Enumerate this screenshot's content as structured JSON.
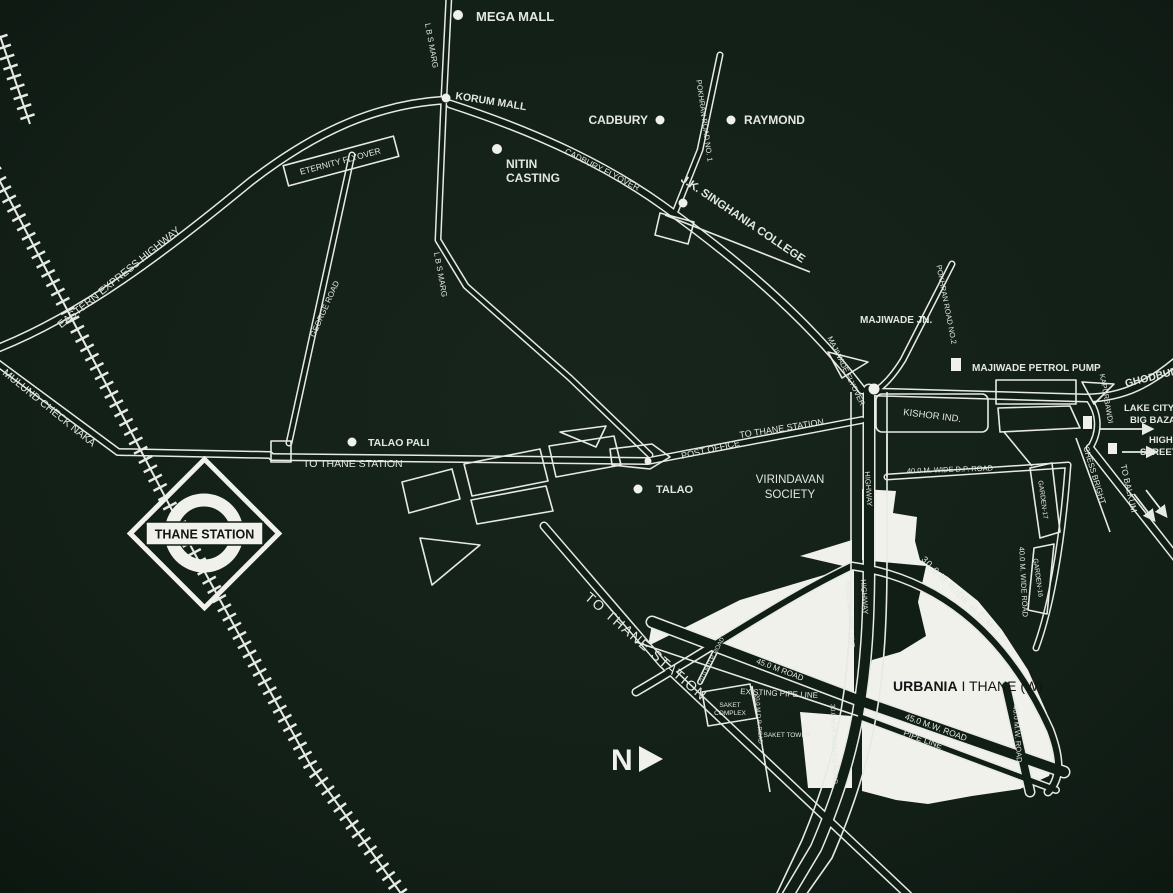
{
  "map": {
    "colors": {
      "background": "#121f17",
      "background_edge": "#0c1710",
      "road": "#e7eae4",
      "label": "#e3e7e1",
      "site": "#eff1ea",
      "dark": "#111e16",
      "text_dark": "#141414"
    },
    "station": {
      "name": "THANE STATION"
    },
    "north": {
      "label": "N"
    },
    "labels": [
      {
        "name": "label-mega-mall",
        "text": "MEGA MALL",
        "x": 476,
        "y": 21,
        "size": 13,
        "weight": 700,
        "anchor": "start"
      },
      {
        "name": "label-korum-mall",
        "text": "KORUM MALL",
        "x": 455,
        "y": 99,
        "rot": 9,
        "size": 10.5,
        "weight": 700,
        "anchor": "start"
      },
      {
        "name": "label-cadbury",
        "text": "CADBURY",
        "x": 648,
        "y": 124,
        "size": 12,
        "weight": 700,
        "anchor": "end"
      },
      {
        "name": "label-raymond",
        "text": "RAYMOND",
        "x": 744,
        "y": 124,
        "size": 12,
        "weight": 700,
        "anchor": "start"
      },
      {
        "name": "label-nitin-casting-1",
        "text": "NITIN",
        "x": 506,
        "y": 168,
        "size": 12,
        "weight": 700,
        "anchor": "start"
      },
      {
        "name": "label-nitin-casting-2",
        "text": "CASTING",
        "x": 506,
        "y": 182,
        "size": 12,
        "weight": 700,
        "anchor": "start"
      },
      {
        "name": "label-eternity-flyover",
        "text": "ETERNITY FLYOVER",
        "x": 341,
        "y": 164,
        "rot": -15,
        "size": 8.5
      },
      {
        "name": "label-eastern-express-highway",
        "text": "EASTERN EXPRESS HIGHWAY",
        "x": 121,
        "y": 280,
        "rot": -39,
        "size": 10.5
      },
      {
        "name": "label-mulund-check-naka",
        "text": "MULUND CHECK NAKA",
        "x": 2,
        "y": 374,
        "rot": 39,
        "size": 10.5,
        "anchor": "start"
      },
      {
        "name": "label-cadbury-flyover",
        "text": "CADBURY FLYOVER",
        "x": 601,
        "y": 172,
        "rot": 27,
        "size": 8.5
      },
      {
        "name": "label-lbs-marg-north",
        "text": "L B S MARG",
        "x": 429,
        "y": 46,
        "rot": 80,
        "size": 8
      },
      {
        "name": "label-lbs-marg-mid",
        "text": "L B S MARG",
        "x": 438,
        "y": 275,
        "rot": 80,
        "size": 8
      },
      {
        "name": "label-george-road",
        "text": "GEORGE ROAD",
        "x": 327,
        "y": 310,
        "rot": -66,
        "size": 8
      },
      {
        "name": "label-pokhran-road-1",
        "text": "POKHRAN ROAD NO. 1",
        "x": 702,
        "y": 121,
        "rot": 82,
        "size": 7.5
      },
      {
        "name": "label-jk-singhania-college",
        "text": "J.K. SINGHANIA COLLEGE",
        "x": 741,
        "y": 222,
        "rot": 34,
        "size": 11.5,
        "weight": 700
      },
      {
        "name": "label-pokhran-road-2",
        "text": "POKHRAN ROAD NO.2",
        "x": 944,
        "y": 305,
        "rot": 79,
        "size": 7.5
      },
      {
        "name": "label-majiwade-jn",
        "text": "MAJIWADE JN.",
        "x": 860,
        "y": 323,
        "size": 10,
        "weight": 700,
        "anchor": "start"
      },
      {
        "name": "label-majiwade-flyover",
        "text": "MAJIWADE FLYOVER",
        "x": 844,
        "y": 372,
        "rot": 64,
        "size": 7.5
      },
      {
        "name": "label-majiwade-petrol-pump",
        "text": "MAJIWADE PETROL PUMP",
        "x": 972,
        "y": 371,
        "size": 10,
        "weight": 700,
        "anchor": "start"
      },
      {
        "name": "label-ghodbunder-road",
        "text": "GHODBUNDER ROAD",
        "x": 1126,
        "y": 387,
        "rot": -14,
        "size": 10.5,
        "weight": 700,
        "anchor": "start"
      },
      {
        "name": "label-kapurbawdi",
        "text": "KAPURBAWDI",
        "x": 1104,
        "y": 399,
        "rot": 80,
        "size": 7.5
      },
      {
        "name": "label-lake-city-mall",
        "text": "LAKE CITY MALL",
        "x": 1124,
        "y": 411,
        "size": 9.5,
        "weight": 700,
        "anchor": "start"
      },
      {
        "name": "label-big-bazaar",
        "text": "BIG BAZAAR",
        "x": 1130,
        "y": 423,
        "size": 9.5,
        "weight": 700,
        "anchor": "start"
      },
      {
        "name": "label-high",
        "text": "HIGH",
        "x": 1149,
        "y": 443,
        "size": 9.5,
        "weight": 700,
        "anchor": "start"
      },
      {
        "name": "label-street-mall",
        "text": "STREET MALL",
        "x": 1140,
        "y": 455,
        "size": 9.5,
        "weight": 700,
        "anchor": "start"
      },
      {
        "name": "label-chess-bright",
        "text": "CHESS BRIGHT",
        "x": 1092,
        "y": 476,
        "rot": 73,
        "size": 8
      },
      {
        "name": "label-to-balkum",
        "text": "TO BALKUM",
        "x": 1126,
        "y": 489,
        "rot": 77,
        "size": 8.5
      },
      {
        "name": "label-kishor-ind",
        "text": "KISHOR IND.",
        "x": 903,
        "y": 415,
        "rot": 7,
        "size": 9.5,
        "anchor": "start"
      },
      {
        "name": "label-to-thane-station-west",
        "text": "TO THANE STATION",
        "x": 303,
        "y": 467,
        "size": 10.5,
        "anchor": "start"
      },
      {
        "name": "label-talao-pali",
        "text": "TALAO PALI",
        "x": 368,
        "y": 446,
        "size": 10.5,
        "weight": 700,
        "anchor": "start"
      },
      {
        "name": "label-post-office",
        "text": "POST OFFICE",
        "x": 682,
        "y": 459,
        "rot": -13,
        "size": 9,
        "anchor": "start"
      },
      {
        "name": "label-to-thane-station-ne",
        "text": "TO THANE STATION",
        "x": 740,
        "y": 438,
        "rot": -9,
        "size": 9,
        "anchor": "start"
      },
      {
        "name": "label-talao",
        "text": "TALAO",
        "x": 656,
        "y": 493,
        "size": 11,
        "weight": 700,
        "anchor": "start"
      },
      {
        "name": "label-virindavan-society-1",
        "text": "VIRINDAVAN",
        "x": 790,
        "y": 483,
        "size": 11.5
      },
      {
        "name": "label-virindavan-society-2",
        "text": "SOCIETY",
        "x": 790,
        "y": 498,
        "size": 11.5
      },
      {
        "name": "label-dp-road-40",
        "text": "40.0 M. WIDE D.P. ROAD",
        "x": 950,
        "y": 472,
        "rot": -2,
        "size": 7.5
      },
      {
        "name": "label-highway-1",
        "text": "HIGHWAY",
        "x": 866,
        "y": 489,
        "rot": 86,
        "size": 7.5
      },
      {
        "name": "label-highway-2",
        "text": "HIGHWAY",
        "x": 862,
        "y": 597,
        "rot": 86,
        "size": 7.5
      },
      {
        "name": "label-existing-pipe-line-v",
        "text": "EXISTING PIPE LINE",
        "x": 848,
        "y": 615,
        "rot": 86,
        "size": 6.8
      },
      {
        "name": "label-wide-road-40",
        "text": "40.0 M. WIDE ROAD",
        "x": 1021,
        "y": 582,
        "rot": 87,
        "size": 7.5
      },
      {
        "name": "label-garden-17",
        "text": "GARDEN-17",
        "x": 1041,
        "y": 500,
        "rot": 82,
        "size": 6.8
      },
      {
        "name": "label-garden-16",
        "text": "GARDEN-16",
        "x": 1036,
        "y": 578,
        "rot": 82,
        "size": 6.8
      },
      {
        "name": "label-hcmtr",
        "text": "30.0 M WIDE H.C.M.T.R.",
        "x": 964,
        "y": 603,
        "rot": 45,
        "size": 9,
        "spacing": 1
      },
      {
        "name": "label-to-thane-station-big",
        "text": "TO THANE STATION",
        "x": 643,
        "y": 650,
        "rot": 41,
        "size": 14,
        "spacing": 1.5
      },
      {
        "name": "label-road-45m",
        "text": "45.0 M ROAD",
        "x": 779,
        "y": 672,
        "rot": 21,
        "size": 8
      },
      {
        "name": "label-existing-pipe-line-h",
        "text": "EXISTING PIPE LINE",
        "x": 779,
        "y": 696,
        "rot": 3,
        "size": 8
      },
      {
        "name": "label-saket-complex-1",
        "text": "SAKET",
        "x": 730,
        "y": 707,
        "size": 6.5
      },
      {
        "name": "label-saket-complex-2",
        "text": "COMPLEX",
        "x": 730,
        "y": 715,
        "size": 6.5
      },
      {
        "name": "label-saket-tower",
        "text": "SAKET TOWER",
        "x": 787,
        "y": 737,
        "size": 6.5
      },
      {
        "name": "label-dp-road-20-diag",
        "text": "20.0 M D.P. ROAD",
        "x": 713,
        "y": 661,
        "rot": -63,
        "size": 6
      },
      {
        "name": "label-dp-road-20-v",
        "text": "20.0 M D.P. ROAD",
        "x": 757,
        "y": 719,
        "rot": 86,
        "size": 6
      },
      {
        "name": "label-service-road-30",
        "text": "30.0 M.W. SERVICE ROAD",
        "x": 832,
        "y": 744,
        "rot": 88,
        "size": 6.5
      },
      {
        "name": "label-road-45mw",
        "text": "45.0 M.W. ROAD",
        "x": 935,
        "y": 730,
        "rot": 20,
        "size": 8.5
      },
      {
        "name": "label-pipe-line",
        "text": "PIPE LINE",
        "x": 922,
        "y": 742,
        "rot": 20,
        "size": 8.5
      },
      {
        "name": "label-road-40mw",
        "text": "40.0 M.W. ROAD",
        "x": 1015,
        "y": 734,
        "rot": 86,
        "size": 7.5
      },
      {
        "name": "label-urbania-thane",
        "text": "URBANIA I THANE (W)",
        "bold_prefix": "URBANIA",
        "x": 893,
        "y": 691,
        "size": 14,
        "anchor": "start",
        "color": "#141414"
      }
    ],
    "poi_dots": [
      {
        "name": "dot-mega-mall",
        "x": 458,
        "y": 15,
        "r": 5
      },
      {
        "name": "dot-korum-mall",
        "x": 446,
        "y": 98,
        "r": 4.5
      },
      {
        "name": "dot-cadbury",
        "x": 660,
        "y": 120,
        "r": 4.5
      },
      {
        "name": "dot-raymond",
        "x": 731,
        "y": 120,
        "r": 4.5
      },
      {
        "name": "dot-nitin-casting",
        "x": 497,
        "y": 149,
        "r": 5
      },
      {
        "name": "dot-jk-singhania-college",
        "x": 683,
        "y": 203,
        "r": 4.5
      },
      {
        "name": "dot-majiwade-jn",
        "x": 874,
        "y": 389,
        "r": 5.5
      },
      {
        "name": "dot-talao-pali",
        "x": 352,
        "y": 442,
        "r": 4.5
      },
      {
        "name": "dot-post-office",
        "x": 648,
        "y": 461,
        "r": 3.5
      },
      {
        "name": "dot-talao",
        "x": 638,
        "y": 489,
        "r": 4.5
      }
    ],
    "poi_squares": [
      {
        "name": "marker-majiwade-petrol-pump",
        "x": 951,
        "y": 358,
        "w": 10,
        "h": 13
      },
      {
        "name": "marker-lake-city-mall",
        "x": 1083,
        "y": 416,
        "w": 9,
        "h": 13
      },
      {
        "name": "marker-high-street-mall",
        "x": 1108,
        "y": 443,
        "w": 9,
        "h": 11
      }
    ]
  }
}
